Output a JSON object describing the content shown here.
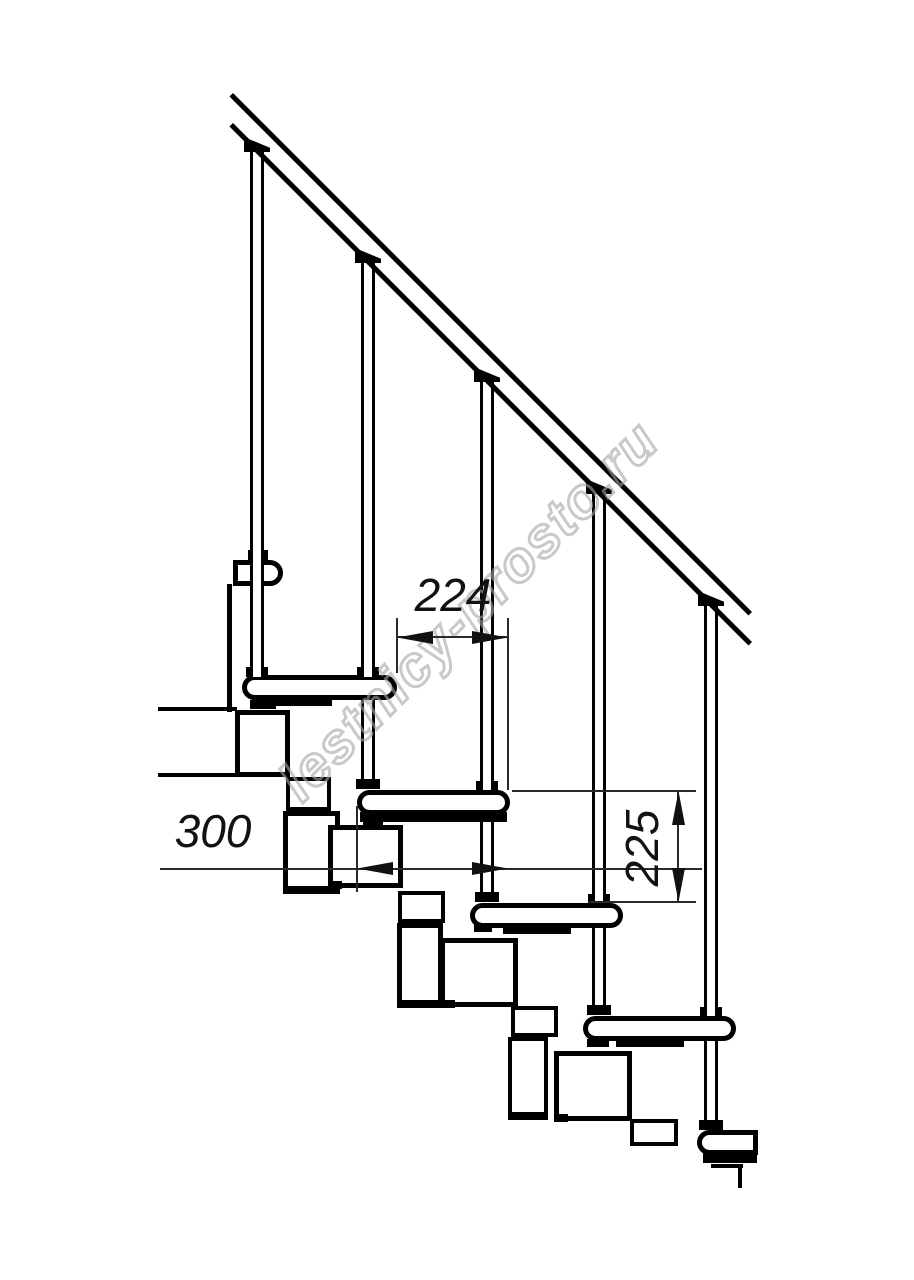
{
  "description": "Side-view technical line drawing of a modular staircase with handrail",
  "watermark": {
    "text": "lestnicy-prosto.ru"
  },
  "dims": {
    "d224": {
      "value": "224",
      "unit": "mm",
      "orientation": "horizontal",
      "role": "step going — horizontal offset between tread nosings"
    },
    "d300": {
      "value": "300",
      "unit": "mm",
      "orientation": "horizontal",
      "role": "tread depth"
    },
    "d225": {
      "value": "225",
      "unit": "mm",
      "orientation": "vertical",
      "role": "riser height between consecutive treads"
    }
  },
  "structure": {
    "treads_visible": 6,
    "balusters_visible": 5,
    "handrail_angle_deg": 45
  },
  "colors": {
    "line": "#000000",
    "dim_line": "#2a2a2a",
    "watermark": "#a5a5a5",
    "background": "#ffffff"
  }
}
